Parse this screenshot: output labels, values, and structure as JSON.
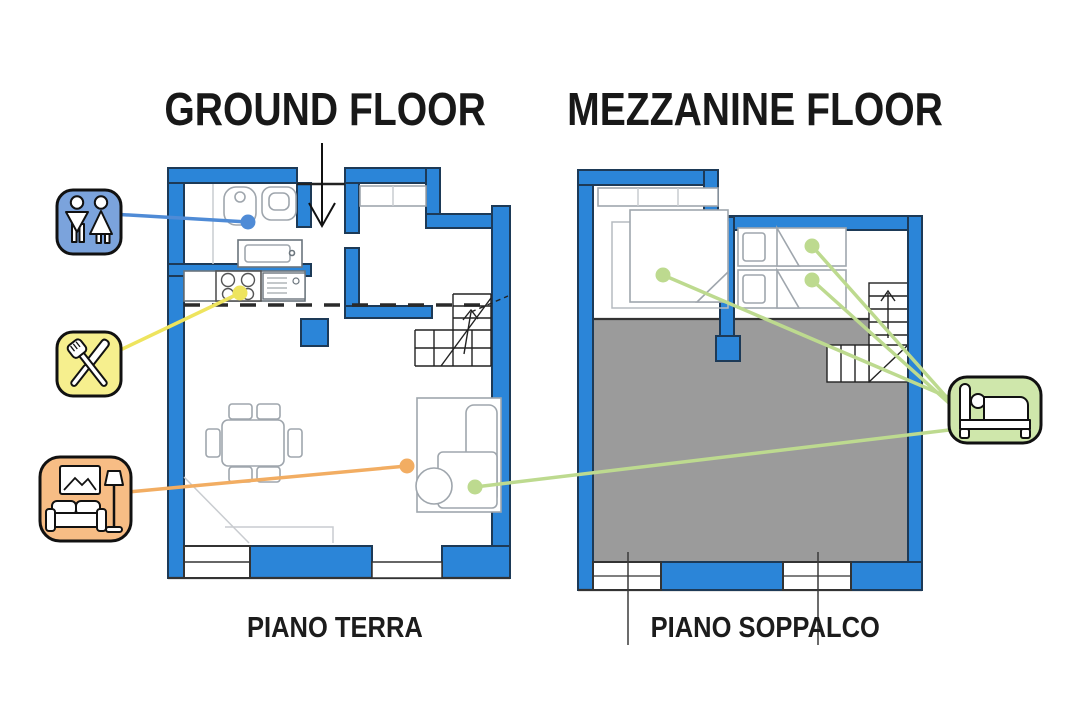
{
  "page": {
    "background": "#ffffff",
    "titles": {
      "ground": "GROUND FLOOR",
      "mezzanine": "MEZZANINE FLOOR"
    },
    "captions": {
      "ground": "PIANO TERRA",
      "mezzanine": "PIANO SOPPALCO"
    }
  },
  "icons": [
    {
      "id": "restroom",
      "name": "restroom-icon",
      "fill": "#7ba3dc",
      "line": "#4f8bd6"
    },
    {
      "id": "cutlery",
      "name": "cutlery-icon",
      "fill": "#f6ef8e",
      "line": "#eee45e"
    },
    {
      "id": "living-room",
      "name": "living-room-icon",
      "fill": "#f7bd85",
      "line": "#f2ad62"
    },
    {
      "id": "bed",
      "name": "bed-icon",
      "fill": "#cfe7ab",
      "line": "#bdda8f"
    }
  ],
  "colors": {
    "wall": "#2b85d8",
    "wall_outline": "#1d3a57",
    "void_area": "#9b9b9b",
    "furniture_line": "#9fa6ad",
    "plan_line": "#222222",
    "text": "#181818"
  }
}
